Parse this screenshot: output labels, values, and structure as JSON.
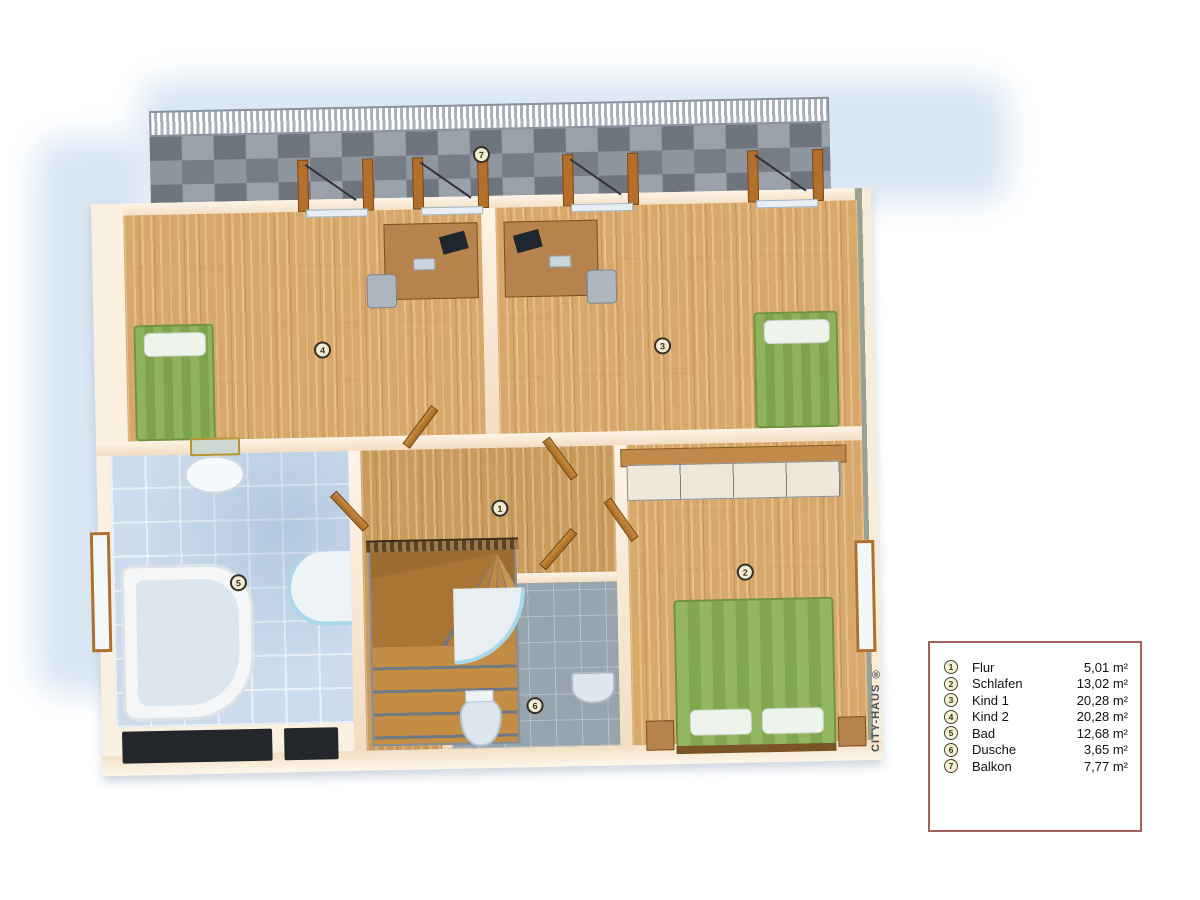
{
  "watermark": {
    "text": "CITY-HAUS ®"
  },
  "legend": {
    "items": [
      {
        "num": "1",
        "name": "Flur",
        "area": "5,01 m²"
      },
      {
        "num": "2",
        "name": "Schlafen",
        "area": "13,02 m²"
      },
      {
        "num": "3",
        "name": "Kind 1",
        "area": "20,28 m²"
      },
      {
        "num": "4",
        "name": "Kind 2",
        "area": "20,28 m²"
      },
      {
        "num": "5",
        "name": "Bad",
        "area": "12,68 m²"
      },
      {
        "num": "6",
        "name": "Dusche",
        "area": "3,65 m²"
      },
      {
        "num": "7",
        "name": "Balkon",
        "area": "7,77 m²"
      }
    ]
  },
  "plan": {
    "markers": [
      {
        "num": "1",
        "room": "Flur"
      },
      {
        "num": "2",
        "room": "Schlafen"
      },
      {
        "num": "3",
        "room": "Kind 1"
      },
      {
        "num": "4",
        "room": "Kind 2"
      },
      {
        "num": "5",
        "room": "Bad"
      },
      {
        "num": "6",
        "room": "Dusche"
      },
      {
        "num": "7",
        "room": "Balkon"
      }
    ],
    "colors": {
      "shadow_blue": "#d9e6f4",
      "wall_cream": "#faf0df",
      "wood_floor": "#d8a76a",
      "balcony_stone": "#848a93",
      "bath_tile_blue": "#ccdcec",
      "shower_tile_gray": "#97a3ad",
      "bed_green": "#8fb35c",
      "door_brown": "#b46f2c",
      "legend_border": "#a2635b"
    }
  }
}
